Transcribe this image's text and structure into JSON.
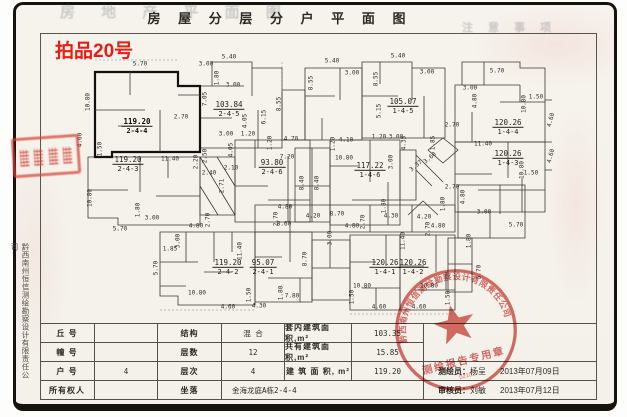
{
  "title": "房 屋 分 层 分 户 平 面 图",
  "auction_no": "拍品20号",
  "ghost_title": "房 地 产 平 面 图",
  "ghost_note": "注 意 事 项",
  "side_company": "黔西南州恒信测绘勘察设计有限责任公司",
  "accent_red": "#ea1d10",
  "seal_red": "#d4554e",
  "plan": {
    "units": [
      {
        "area": "119.20",
        "no": "2-4-4",
        "x": 137,
        "y": 126,
        "bold": true
      },
      {
        "area": "103.84",
        "no": "2-4-5",
        "x": 229,
        "y": 109
      },
      {
        "area": "119.20",
        "no": "2-4-3",
        "x": 128,
        "y": 164
      },
      {
        "area": "93.80",
        "no": "2-4-6",
        "x": 272,
        "y": 167
      },
      {
        "area": "105.07",
        "no": "1-4-5",
        "x": 403,
        "y": 106
      },
      {
        "area": "117.22",
        "no": "1-4-6",
        "x": 370,
        "y": 170
      },
      {
        "area": "120.26",
        "no": "1-4-4",
        "x": 508,
        "y": 127
      },
      {
        "area": "120.26",
        "no": "1-4-3",
        "x": 508,
        "y": 158
      },
      {
        "area": "119.20",
        "no": "2-4-2",
        "x": 228,
        "y": 267
      },
      {
        "area": "95.07",
        "no": "2-4-1",
        "x": 263,
        "y": 267
      },
      {
        "area": "120.26",
        "no": "1-4-1",
        "x": 385,
        "y": 267
      },
      {
        "area": "120.26",
        "no": "1-4-2",
        "x": 413,
        "y": 267
      }
    ],
    "dims": [
      {
        "v": "5.70",
        "x": 140,
        "y": 64,
        "r": 0
      },
      {
        "v": "1.80",
        "x": 217,
        "y": 78,
        "r": 90
      },
      {
        "v": "3.00",
        "x": 233,
        "y": 85,
        "r": 0
      },
      {
        "v": "10.80",
        "x": 88,
        "y": 102,
        "r": 90
      },
      {
        "v": "4.60",
        "x": 80,
        "y": 140,
        "r": 90
      },
      {
        "v": "1.50",
        "x": 100,
        "y": 149,
        "r": 90
      },
      {
        "v": "2.70",
        "x": 181,
        "y": 117,
        "r": 0
      },
      {
        "v": "7.05",
        "x": 205,
        "y": 99,
        "r": 90
      },
      {
        "v": "11.40",
        "x": 170,
        "y": 159,
        "r": 0
      },
      {
        "v": "5.40",
        "x": 229,
        "y": 57,
        "r": 0
      },
      {
        "v": "3.00",
        "x": 206,
        "y": 64,
        "r": 0
      },
      {
        "v": "8.55",
        "x": 279,
        "y": 104,
        "r": 90
      },
      {
        "v": "4.05",
        "x": 245,
        "y": 121,
        "r": 90
      },
      {
        "v": "3.00",
        "x": 226,
        "y": 134,
        "r": 0
      },
      {
        "v": "1.20",
        "x": 248,
        "y": 134,
        "r": 0
      },
      {
        "v": "10.80",
        "x": 90,
        "y": 198,
        "r": 90
      },
      {
        "v": "5.70",
        "x": 120,
        "y": 229,
        "r": 0
      },
      {
        "v": "1.80",
        "x": 138,
        "y": 210,
        "r": 90
      },
      {
        "v": "3.00",
        "x": 152,
        "y": 218,
        "r": 0
      },
      {
        "v": "2.20",
        "x": 196,
        "y": 162,
        "r": 90
      },
      {
        "v": "2.50",
        "x": 205,
        "y": 156,
        "r": 90
      },
      {
        "v": "2.40",
        "x": 209,
        "y": 173,
        "r": 0
      },
      {
        "v": "2.10",
        "x": 231,
        "y": 168,
        "r": 0
      },
      {
        "v": "2.71",
        "x": 222,
        "y": 186,
        "r": 90
      },
      {
        "v": "4.05",
        "x": 231,
        "y": 150,
        "r": 90
      },
      {
        "v": "6.15",
        "x": 264,
        "y": 117,
        "r": 90
      },
      {
        "v": "1.20",
        "x": 270,
        "y": 143,
        "r": 90
      },
      {
        "v": "4.70",
        "x": 291,
        "y": 139,
        "r": 0
      },
      {
        "v": "7.20",
        "x": 287,
        "y": 157,
        "r": 0
      },
      {
        "v": "8.40",
        "x": 302,
        "y": 183,
        "r": 90
      },
      {
        "v": "8.40",
        "x": 317,
        "y": 183,
        "r": 90
      },
      {
        "v": "4.20",
        "x": 313,
        "y": 216,
        "r": 0
      },
      {
        "v": "4.80",
        "x": 285,
        "y": 207,
        "r": 0
      },
      {
        "v": "8.70",
        "x": 337,
        "y": 214,
        "r": 0
      },
      {
        "v": "8.60",
        "x": 284,
        "y": 224,
        "r": 0
      },
      {
        "v": "2.70",
        "x": 276,
        "y": 219,
        "r": 90
      },
      {
        "v": "4.80",
        "x": 352,
        "y": 226,
        "r": 0
      },
      {
        "v": "2.70",
        "x": 363,
        "y": 222,
        "r": 90
      },
      {
        "v": "1.80",
        "x": 384,
        "y": 206,
        "r": 90
      },
      {
        "v": "4.30",
        "x": 391,
        "y": 216,
        "r": 0
      },
      {
        "v": "3.00",
        "x": 330,
        "y": 238,
        "r": 90
      },
      {
        "v": "4.20",
        "x": 424,
        "y": 217,
        "r": 0
      },
      {
        "v": "1.80",
        "x": 443,
        "y": 204,
        "r": 90
      },
      {
        "v": "4.80",
        "x": 438,
        "y": 226,
        "r": 0
      },
      {
        "v": "2.70",
        "x": 428,
        "y": 229,
        "r": 90
      },
      {
        "v": "5.40",
        "x": 332,
        "y": 61,
        "r": 0
      },
      {
        "v": "3.00",
        "x": 352,
        "y": 73,
        "r": 0
      },
      {
        "v": "8.55",
        "x": 311,
        "y": 83,
        "r": 90
      },
      {
        "v": "5.40",
        "x": 398,
        "y": 56,
        "r": 0
      },
      {
        "v": "8.55",
        "x": 376,
        "y": 79,
        "r": 90
      },
      {
        "v": "3.00",
        "x": 427,
        "y": 72,
        "r": 0
      },
      {
        "v": "5.15",
        "x": 379,
        "y": 111,
        "r": 90
      },
      {
        "v": "1.20",
        "x": 379,
        "y": 137,
        "r": 0
      },
      {
        "v": "3.00",
        "x": 396,
        "y": 137,
        "r": 0
      },
      {
        "v": "4.35",
        "x": 404,
        "y": 143,
        "r": 90
      },
      {
        "v": "1.85",
        "x": 433,
        "y": 143,
        "r": 90
      },
      {
        "v": "3.37",
        "x": 416,
        "y": 166,
        "r": 40
      },
      {
        "v": "3.60",
        "x": 430,
        "y": 158,
        "r": 40
      },
      {
        "v": "4.10",
        "x": 346,
        "y": 140,
        "r": 0
      },
      {
        "v": "1.20",
        "x": 333,
        "y": 144,
        "r": 90
      },
      {
        "v": "10.80",
        "x": 344,
        "y": 158,
        "r": 0
      },
      {
        "v": "3.00",
        "x": 391,
        "y": 162,
        "r": 90
      },
      {
        "v": "5.70",
        "x": 497,
        "y": 71,
        "r": 0
      },
      {
        "v": "3.00",
        "x": 470,
        "y": 88,
        "r": 0
      },
      {
        "v": "4.80",
        "x": 475,
        "y": 101,
        "r": 90
      },
      {
        "v": "10.80",
        "x": 524,
        "y": 104,
        "r": 90
      },
      {
        "v": "1.50",
        "x": 536,
        "y": 97,
        "r": 0
      },
      {
        "v": "4.60",
        "x": 551,
        "y": 120,
        "r": 75
      },
      {
        "v": "2.70",
        "x": 452,
        "y": 125,
        "r": 0
      },
      {
        "v": "11.40",
        "x": 483,
        "y": 144,
        "r": 0
      },
      {
        "v": "4.60",
        "x": 551,
        "y": 156,
        "r": 75
      },
      {
        "v": "2.70",
        "x": 452,
        "y": 187,
        "r": 0
      },
      {
        "v": "4.80",
        "x": 463,
        "y": 197,
        "r": 90
      },
      {
        "v": "1.50",
        "x": 531,
        "y": 173,
        "r": 0
      },
      {
        "v": "10.80",
        "x": 522,
        "y": 170,
        "r": 90
      },
      {
        "v": "1.85",
        "x": 170,
        "y": 249,
        "r": 0
      },
      {
        "v": "3.00",
        "x": 178,
        "y": 241,
        "r": 90
      },
      {
        "v": "5.70",
        "x": 156,
        "y": 268,
        "r": 90
      },
      {
        "v": "10.80",
        "x": 197,
        "y": 293,
        "r": 0
      },
      {
        "v": "1.50",
        "x": 249,
        "y": 295,
        "r": 90
      },
      {
        "v": "4.60",
        "x": 228,
        "y": 307,
        "r": 0
      },
      {
        "v": "11.40",
        "x": 240,
        "y": 251,
        "r": 90
      },
      {
        "v": "4.80",
        "x": 196,
        "y": 226,
        "r": 0
      },
      {
        "v": "2.70",
        "x": 208,
        "y": 220,
        "r": 90
      },
      {
        "v": "8.70",
        "x": 305,
        "y": 259,
        "r": 90
      },
      {
        "v": "7.80",
        "x": 292,
        "y": 296,
        "r": 0
      },
      {
        "v": "4.30",
        "x": 259,
        "y": 306,
        "r": 0
      },
      {
        "v": "1.80",
        "x": 281,
        "y": 293,
        "r": 90
      },
      {
        "v": "10.80",
        "x": 362,
        "y": 286,
        "r": 0
      },
      {
        "v": "1.50",
        "x": 352,
        "y": 297,
        "r": 90
      },
      {
        "v": "4.60",
        "x": 379,
        "y": 307,
        "r": 0
      },
      {
        "v": "10.80",
        "x": 429,
        "y": 286,
        "r": 0
      },
      {
        "v": "4.60",
        "x": 419,
        "y": 307,
        "r": 0
      },
      {
        "v": "1.50",
        "x": 448,
        "y": 298,
        "r": 90
      },
      {
        "v": "11.40",
        "x": 403,
        "y": 241,
        "r": 90
      },
      {
        "v": "5.70",
        "x": 479,
        "y": 272,
        "r": 90
      },
      {
        "v": "5.70",
        "x": 516,
        "y": 225,
        "r": 0
      },
      {
        "v": "3.00",
        "x": 484,
        "y": 212,
        "r": 0
      },
      {
        "v": "1.80",
        "x": 469,
        "y": 241,
        "r": 90
      }
    ]
  },
  "table": {
    "r1": {
      "l": "丘  号",
      "v": "",
      "l2": "结构",
      "v2": "混 合",
      "l3": "套内建筑面积,m²",
      "v3": "103.35"
    },
    "r2": {
      "l": "幢  号",
      "v": "",
      "l2": "层数",
      "v2": "12",
      "l3": "共有建筑面积,m²",
      "v3": "15.85"
    },
    "r3": {
      "l": "户  号",
      "v": "4",
      "l2": "层次",
      "v2": "4",
      "l3": "建 筑 面 积, m²",
      "v3": "119.20"
    },
    "r4": {
      "l": "所有权人",
      "v": "",
      "l2": "坐落",
      "v2": "金海龙庭A栋2-4-4"
    },
    "surveyor_label": "测绘员：",
    "surveyor_name": "杨呈",
    "surveyor_date": "2013年07月09日",
    "reviewer_label": "审核员：",
    "reviewer_name": "刘敏",
    "reviewer_date": "2013年07月12日"
  },
  "seal": {
    "arc": "黔西南州恒信测绘勘察设计有限责任公司",
    "title": "测绘报告专用章",
    "code": "02102"
  }
}
